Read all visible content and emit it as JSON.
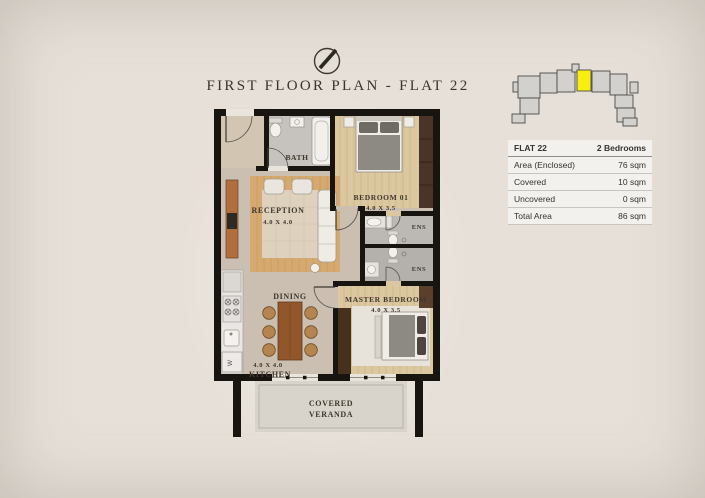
{
  "header": {
    "title": "FIRST FLOOR PLAN - FLAT 22"
  },
  "key_plan": {
    "highlight_color": "#f8ee11",
    "block_color": "#d3d1ce"
  },
  "info_table": {
    "header": {
      "label": "FLAT 22",
      "value": "2 Bedrooms"
    },
    "rows": [
      {
        "label": "Area (Enclosed)",
        "value": "76 sqm"
      },
      {
        "label": "Covered",
        "value": "10 sqm"
      },
      {
        "label": "Uncovered",
        "value": "0 sqm"
      },
      {
        "label": "Total Area",
        "value": "86 sqm"
      }
    ]
  },
  "floor_plan": {
    "rooms": {
      "bath": {
        "name": "BATH"
      },
      "reception": {
        "name": "RECEPTION",
        "dims": "4.0 X 4.0"
      },
      "bedroom01": {
        "name": "BEDROOM 01",
        "dims": "4.0 X 3.5"
      },
      "ens_top": {
        "name": "ENS"
      },
      "ens_bottom": {
        "name": "ENS"
      },
      "dining": {
        "name": "DINING"
      },
      "kitchen": {
        "name": "KITCHEN",
        "dims": "4.0 X 4.0"
      },
      "master": {
        "name": "MASTER BEDROOM",
        "dims": "4.0 X 3.5"
      },
      "veranda": {
        "line1": "COVERED",
        "line2": "VERANDA"
      }
    },
    "appliances": {
      "washer": "W"
    },
    "colors": {
      "wall": "#181410",
      "wood_floor": "#dcc8a0",
      "reception_wood": "#d5a96f",
      "tile_gray": "#bfbcb8",
      "taupe_floor": "#cabfb1",
      "veranda_floor": "#d9d4cb"
    }
  }
}
